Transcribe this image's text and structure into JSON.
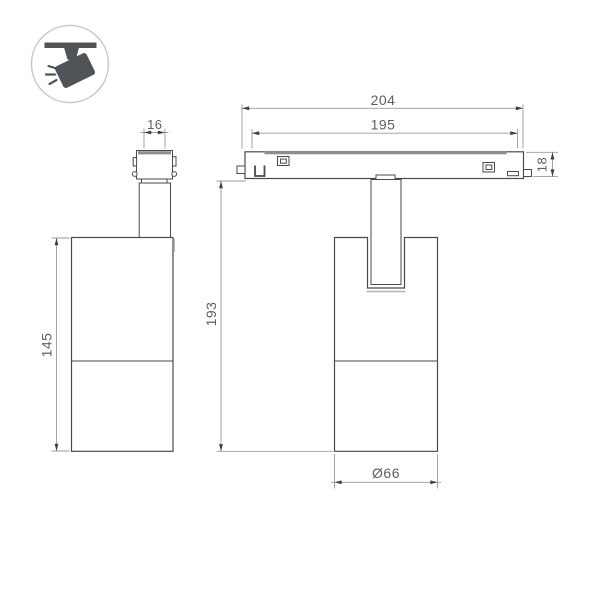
{
  "drawing": {
    "title": "track-spotlight-dimension-drawing",
    "icon": {
      "name": "track-spotlight-icon",
      "color": "#4e5458",
      "ring_color": "#c8c8c8"
    },
    "side_view": {
      "dimensions": {
        "adapter_width": "16",
        "body_height": "145"
      }
    },
    "front_view": {
      "dimensions": {
        "track_length": "204",
        "track_inner_length": "195",
        "track_height": "18",
        "overall_height": "193",
        "body_diameter": "Ø66"
      }
    },
    "colors": {
      "object_line": "#4a4a4a",
      "dimension_line": "#9a9a9a",
      "text": "#5f5f5f",
      "accent_strip": "#8e8e8e",
      "background": "#ffffff"
    }
  }
}
